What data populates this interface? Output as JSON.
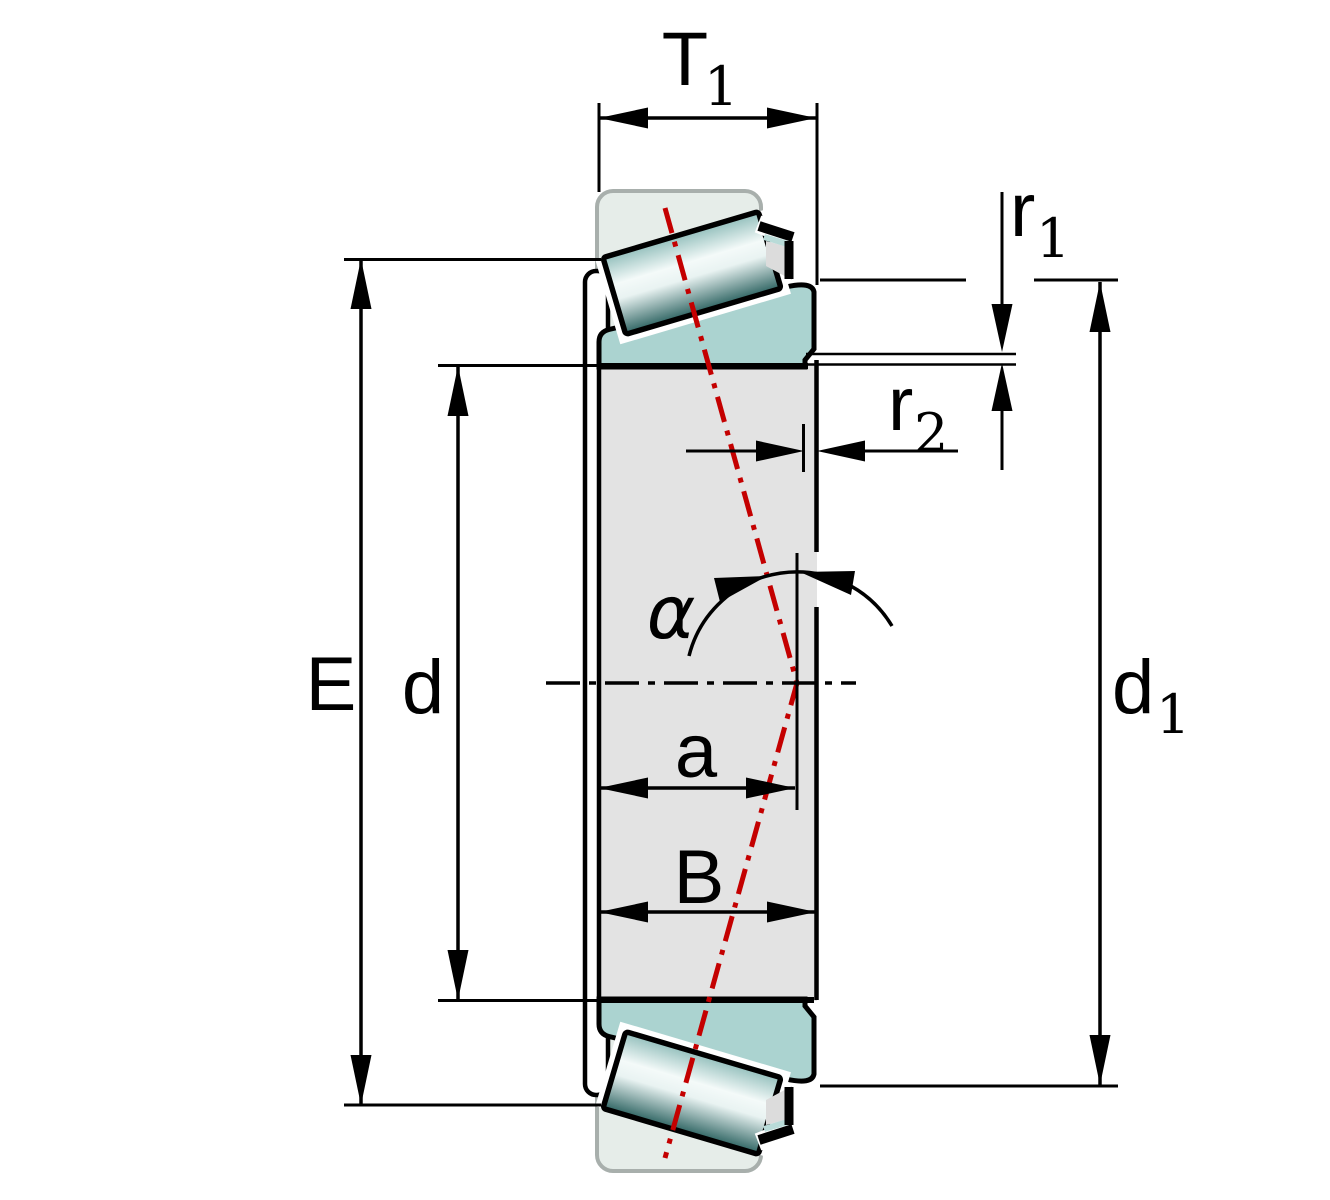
{
  "diagram": {
    "type": "engineering-dimension-drawing",
    "subject": "tapered-roller-bearing-cross-section",
    "labels": {
      "T1": {
        "main": "T",
        "sub": "1"
      },
      "r1": {
        "main": "r",
        "sub": "1"
      },
      "r2": {
        "main": "r",
        "sub": "2"
      },
      "E": "E",
      "d": "d",
      "d1": {
        "main": "d",
        "sub": "1"
      },
      "a": "a",
      "B": "B",
      "alpha": "α"
    },
    "colors": {
      "background": "#ffffff",
      "outline": "#000000",
      "pressure_line_red": "#c40000",
      "inner_ring_body": "#e3e3e3",
      "rib_flange_teal": "#abd3d0",
      "phantom_cup_fill": "#e6ede9",
      "phantom_cup_stroke": "#a8afac",
      "roller_mid": "#93bfbc",
      "roller_light": "#f4faf9",
      "roller_dark": "#2e6462",
      "cage_sliver": "#b9dbd8"
    }
  }
}
